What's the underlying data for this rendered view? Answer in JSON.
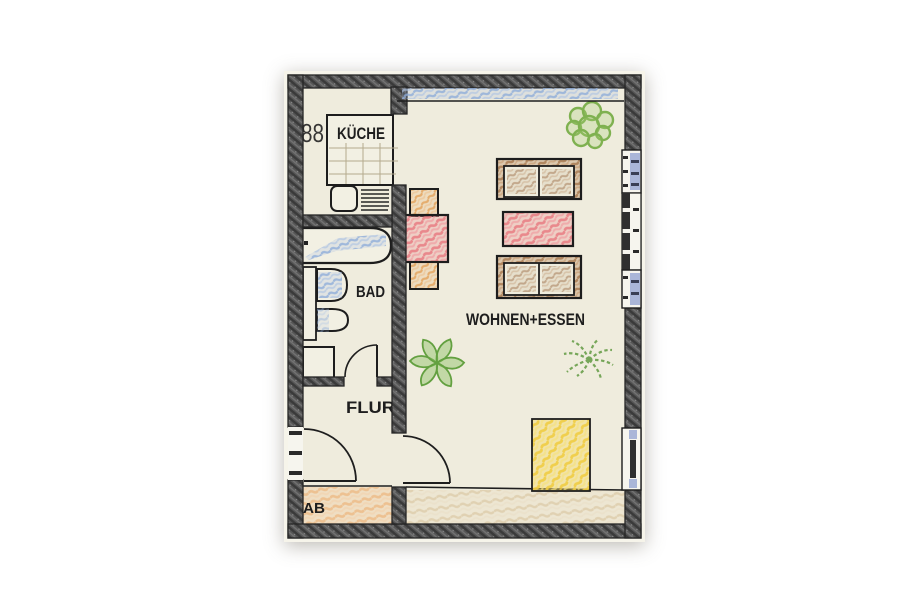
{
  "document": {
    "kind": "hand-drawn apartment floor plan",
    "style": "colored pencil on scanned paper"
  },
  "rooms": {
    "kitchen": "KÜCHE",
    "bath": "BAD",
    "hall": "FLUR",
    "living": "WOHNEN+ESSEN",
    "storage": "AB"
  },
  "fixtures": {
    "cooktop": "88"
  },
  "icons": {
    "cooktop": "cooktop-burners-icon",
    "bathtub": "bathtub-icon",
    "washbasin": "washbasin-icon",
    "toilet": "toilet-icon",
    "washing_machine": "washing-machine-icon",
    "sink": "kitchen-sink-icon",
    "plants": "potted-plant-icon",
    "doors": "door-swing-arc-icon"
  },
  "colors": {
    "wall": "#4f4f4f",
    "paper": "#efecdd",
    "ink": "#1e1e1e",
    "water_blue": "#9db8dd",
    "window_blue": "#aab6d8",
    "table_red": "#ed8b90",
    "chair_orange": "#e9b175",
    "sofa_brown": "#bd9066",
    "cushion_tan": "#c4a885",
    "rug_yellow": "#f4d75c",
    "plant_green": "#85b957",
    "balcony_peach": "#f1c79b",
    "terrace_sand": "#e6d9bd"
  }
}
